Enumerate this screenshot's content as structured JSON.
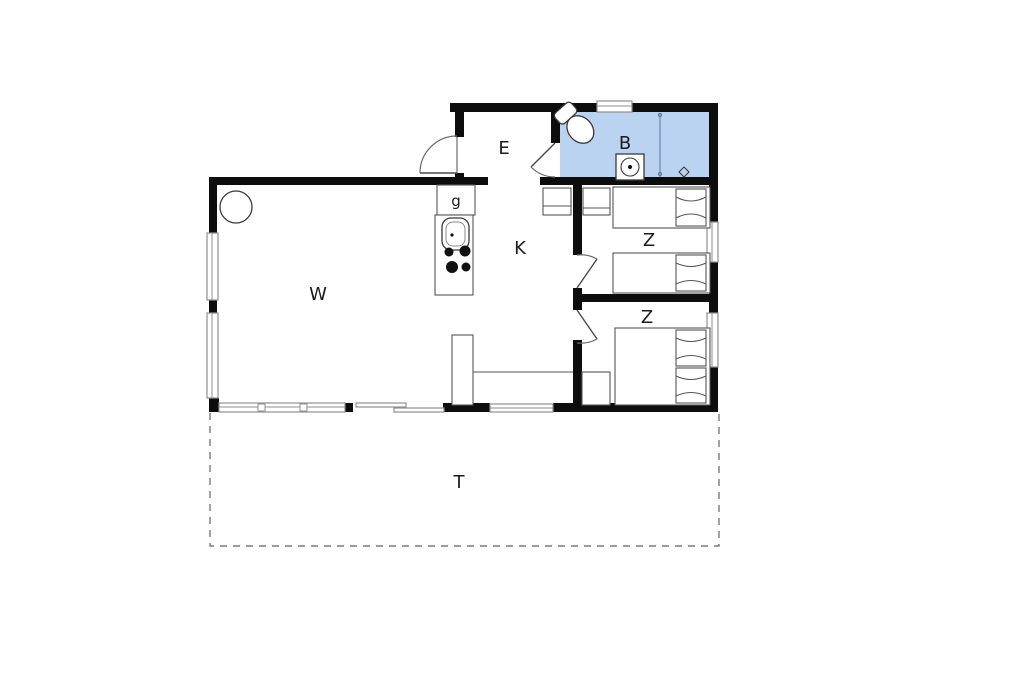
{
  "plan": {
    "rooms": [
      {
        "key": "living-room",
        "label": "W"
      },
      {
        "key": "kitchen",
        "label": "K"
      },
      {
        "key": "entrance",
        "label": "E"
      },
      {
        "key": "bathroom",
        "label": "B"
      },
      {
        "key": "utility",
        "label": "g"
      },
      {
        "key": "bedroom-1",
        "label": "Z"
      },
      {
        "key": "bedroom-2",
        "label": "Z"
      },
      {
        "key": "terrace",
        "label": "T"
      }
    ],
    "colors": {
      "bathroom_fill": "#b9d3f1",
      "wall": "#0d0d0d",
      "window_line": "#8f8f8f",
      "terrace_dash": "#7b7b7b"
    },
    "fixtures": [
      "toilet-icon",
      "shower-drain-icon",
      "floor-drain-icon",
      "sink-icon",
      "cooktop-icon",
      "wood-stove-icon",
      "bed-icon",
      "wardrobe-icon"
    ]
  }
}
